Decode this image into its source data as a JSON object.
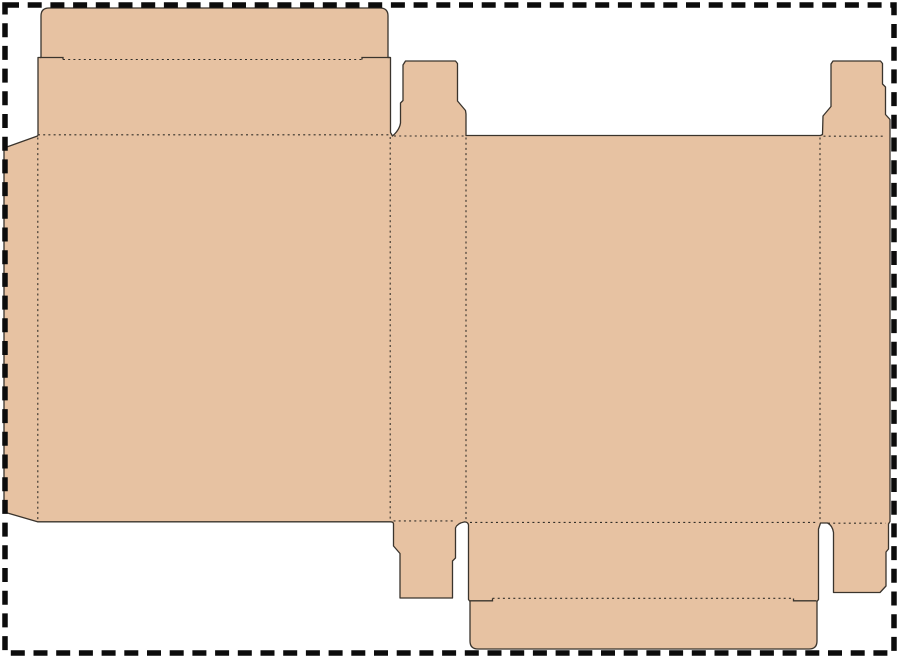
{
  "canvas": {
    "width": 900,
    "height": 658,
    "background": "#ffffff"
  },
  "palette": {
    "board_fill": "#e7c2a2",
    "cut_line": "#3a342d",
    "fold_line": "#332f29",
    "page_border": "#0c0c0c",
    "background": "#ffffff"
  },
  "page_border": {
    "x": 5,
    "y": 5,
    "width": 889,
    "height": 648,
    "thickness": 5.5,
    "dash": "14 8.7"
  },
  "dieline": {
    "kind": "reverse-tuck-end-carton-blank",
    "parts": [
      "top-tuck-flap",
      "top-lid-panel",
      "front-panel",
      "left-dust-flap",
      "spine-side-panel",
      "spine-top-dust-tab",
      "back-panel",
      "right-side-panel",
      "right-top-dust-tab",
      "bottom-lid-panel",
      "bottom-tuck-flap",
      "spine-bottom-dust-tab",
      "right-bottom-dust-flap"
    ],
    "cut_width": 1.3,
    "fold_width": 1.1,
    "fold_dash": "2 3.2",
    "silhouette_path": "M49,8 L380,8 Q388,8 388,16 L388,57.5 L390.5,57.5 L390.5,132.5 L392.5,136 Q399.5,130 400.5,123 L400.5,103 L403,100.5 L403,65 L405.5,61 L455.5,61 L457.5,63.5 L457.5,101 L465.5,110.5 L466,114 L466,135.5 L820.5,135.5 L822.5,134.5 L823,116 L831,106.5 L831,64 L833,61 L880.5,61 L882.5,63.5 L882.5,84 L885.5,87 L885.5,114.5 L890,119.5 L890,521.5 L888.5,524 L888.5,549 L886,552 L886,586 L880,592.5 L833.5,592.5 L833.5,532.5 Q832.5,525.5 827.5,523 L820.5,523 L818.5,529 L818.5,599.5 L817,601.5 L817,641 Q817,649 809,649 L478,649 Q470,649 470,641 L470,601.5 L468.5,599.5 L468.5,525 Q468,522 464.5,521.9 Q457,523.5 455.5,528 L455.5,558 L452.5,561 L452.5,598 L400,598 L400,553.5 L393.5,546 L393.5,523.5 Q393,521.8 390.5,521.8 L37.5,521.8 L4,512 L4,148 L37.5,136 L38,135 L38,57.5 L41,57.5 L41,16 Q41,8 49,8 Z",
    "relief_cut_paths": [
      "M40,57.5 L63,57.5 L63,59.5",
      "M362,59.5 L362,57.5 L390,57.5",
      "M470,600.8 L492.5,600.8 L492.5,598.5",
      "M793.5,598.5 L793.5,600.8 L816.5,600.8"
    ],
    "fold_line_paths": [
      "M63,59.5 L362,59.5",
      "M38,134.8 L390,134.8",
      "M394,136 L464.5,136",
      "M823.5,136.2 L884,136.2",
      "M37.8,137.5 L37.8,520.5",
      "M390.2,137 L390.2,520.5",
      "M466,137.5 L466,521",
      "M820,137.5 L820,521.5",
      "M393.5,520.9 L455,520.9",
      "M470,522.4 L818,522.4",
      "M828,523.2 L885.5,523.2",
      "M492.5,598.3 L793.5,598.3"
    ]
  }
}
